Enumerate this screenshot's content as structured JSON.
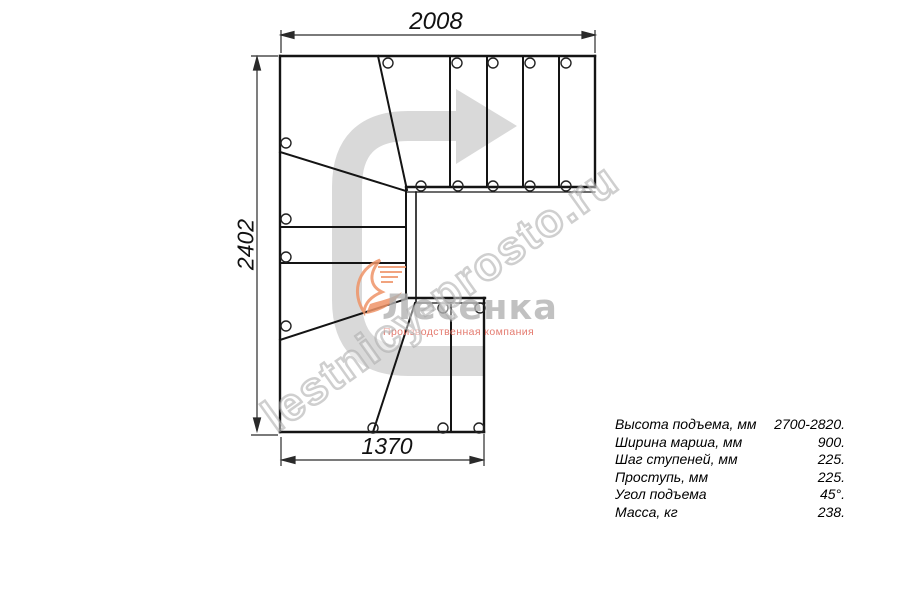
{
  "dimensions": {
    "top": "2008",
    "left": "2402",
    "bottom": "1370"
  },
  "specs": {
    "rows": [
      {
        "label": "Высота подъема, мм",
        "value": "2700-2820."
      },
      {
        "label": "Ширина марша, мм",
        "value": "900."
      },
      {
        "label": "Шаг ступеней, мм",
        "value": "225."
      },
      {
        "label": "Проступь, мм",
        "value": "225."
      },
      {
        "label": "Угол подъема",
        "value": "45°."
      },
      {
        "label": "Масса, кг",
        "value": "238."
      }
    ]
  },
  "watermark": {
    "site": "lestnicy-prosto.ru",
    "logo_name": "Лесенка",
    "logo_tagline": "Производственная компания"
  },
  "icons": {
    "direction_arrow": "u-turn-walkline-arrow",
    "logo_mark": "orange-swoosh"
  },
  "colors": {
    "line": "#141414",
    "dimension": "#2a2a2a",
    "arrow_gray": "#d9d9d9",
    "watermark_gray": "#a8a8a8",
    "logo_gray": "#b2b2b2",
    "logo_orange": "#ef9468",
    "logo_red": "#e27064"
  }
}
